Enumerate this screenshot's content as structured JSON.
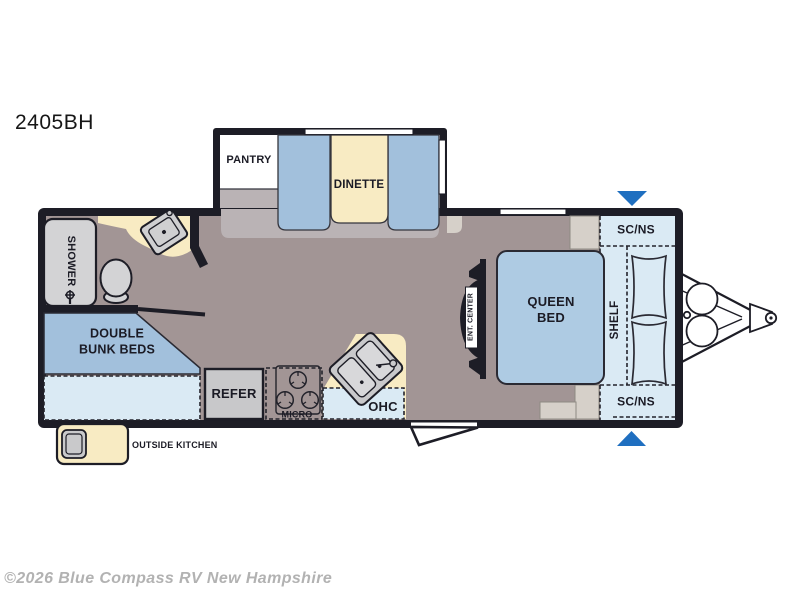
{
  "title": "2405BH",
  "watermark": "©2026 Blue Compass RV New Hampshire",
  "labels": {
    "pantry": "PANTRY",
    "dinette": "DINETTE",
    "shower": "SHOWER",
    "bunks_line1": "DOUBLE",
    "bunks_line2": "BUNK BEDS",
    "refer": "REFER",
    "micro": "MICRO",
    "ohc": "OHC",
    "ent_center": "ENT. CENTER",
    "queen_line1": "QUEEN",
    "queen_line2": "BED",
    "shelf": "SHELF",
    "scns_front_top": "SC/NS",
    "scns_front_bottom": "SC/NS",
    "outside_kitchen": "OUTSIDE KITCHEN"
  },
  "colors": {
    "wall": "#1d1d26",
    "floor": "#a29595",
    "slide_floor": "#bab3b5",
    "seat_blue": "#a2c0dc",
    "bed_blue": "#aecbe3",
    "overhead_blue": "#daeaf4",
    "counter_tan": "#f8ebc3",
    "fixture_gray": "#d3d3d5",
    "cabinet_gray": "#d6d0c9",
    "arrow_blue": "#1f6fc0",
    "watermark_gray": "#b2b2b2"
  }
}
